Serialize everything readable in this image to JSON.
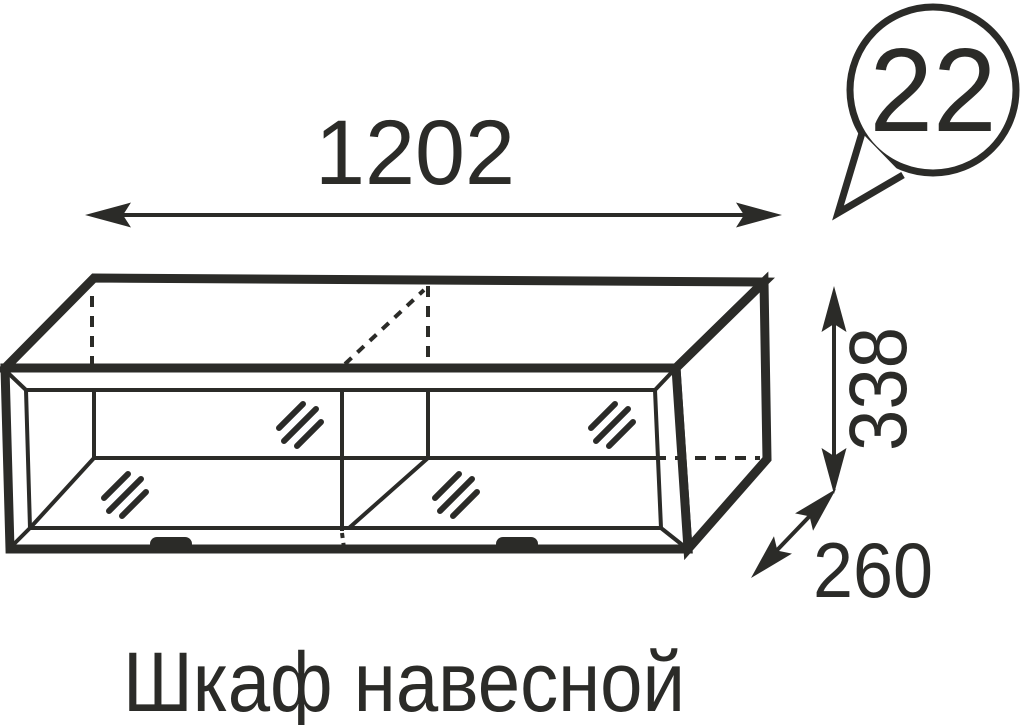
{
  "callout": {
    "number": "22"
  },
  "dimensions": {
    "width": "1202",
    "height": "338",
    "depth": "260"
  },
  "caption": "Шкаф навесной",
  "colors": {
    "ink": "#2b2b28",
    "background": "#ffffff"
  }
}
